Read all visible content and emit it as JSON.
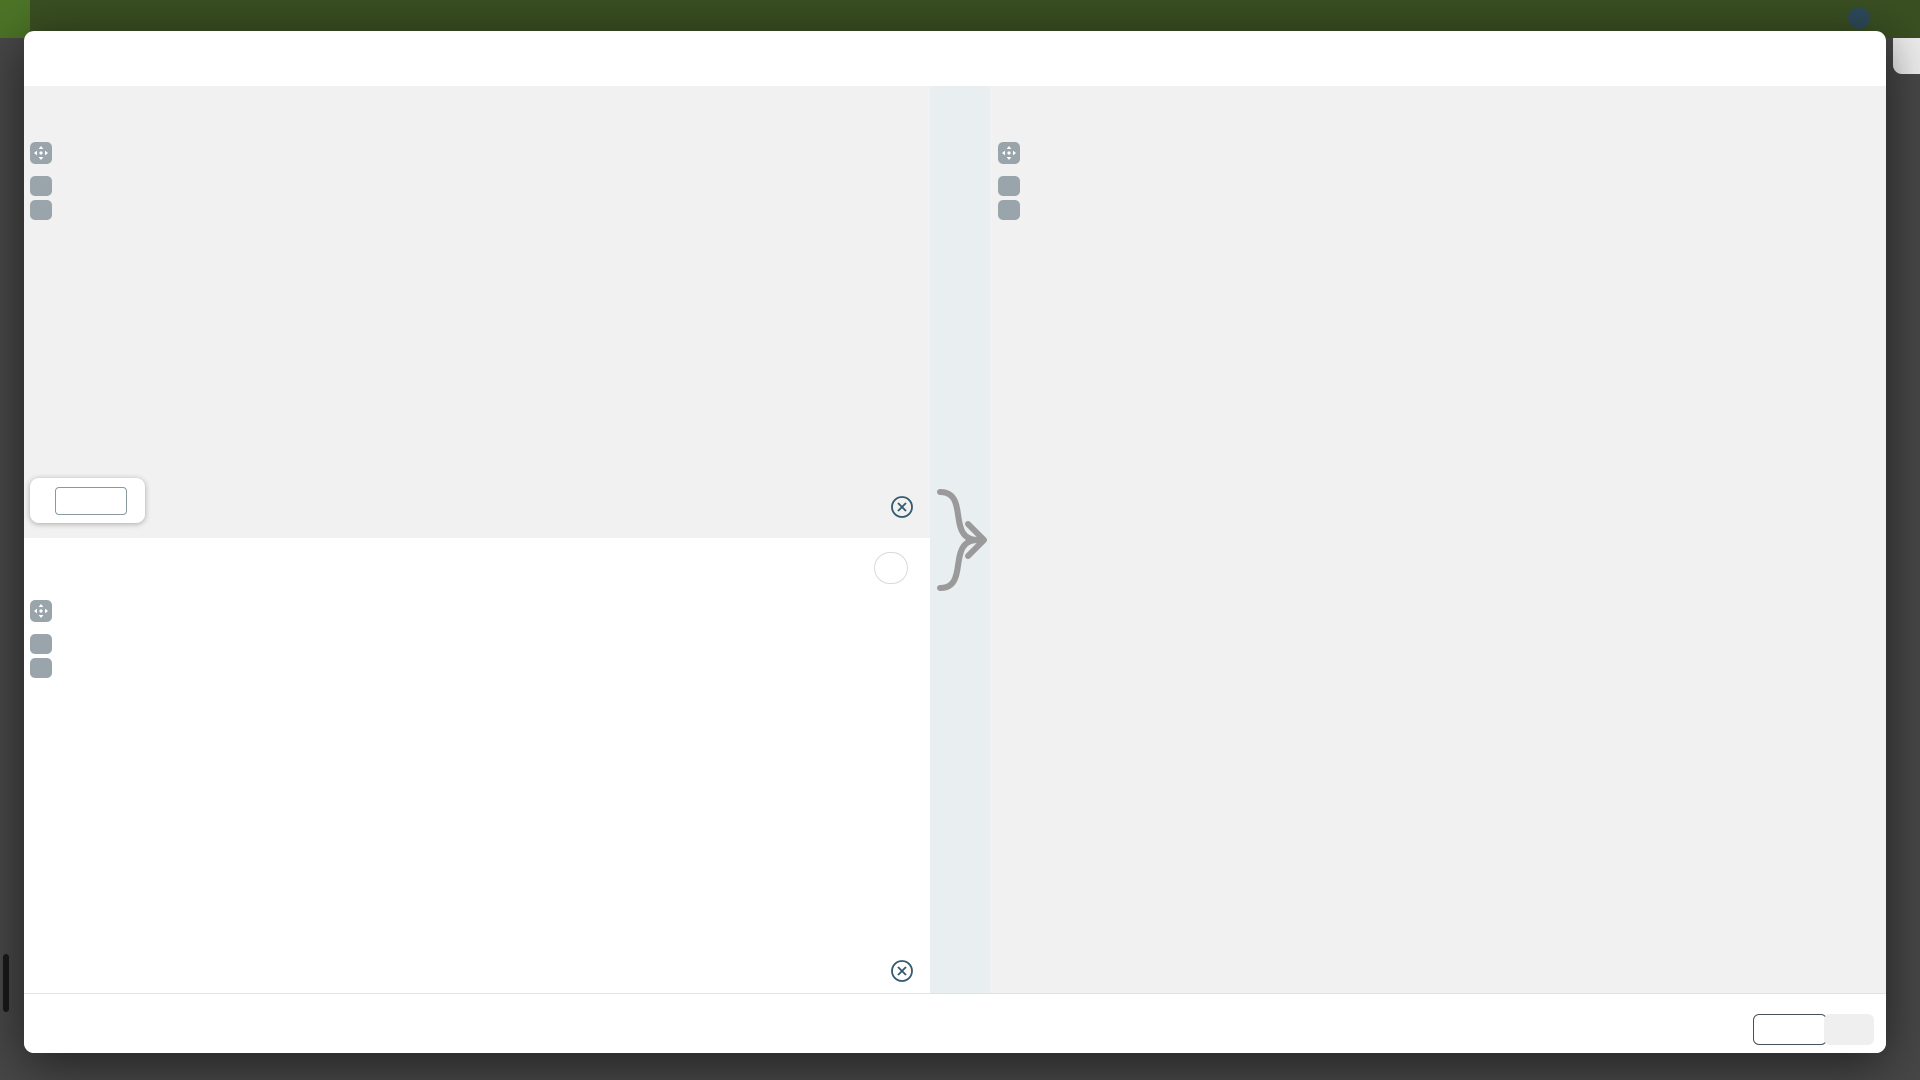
{
  "background": {
    "locations": "Locations",
    "user_name": "Søren Lang",
    "user_initials": "SL",
    "help": "Help",
    "chevron": "⌄"
  },
  "modal": {
    "title": "Place the drawing on the level 'LEVEL 00' in relation to the 3D model",
    "close": "✕"
  },
  "controls": {
    "plus": "+",
    "minus": "−"
  },
  "footer": {
    "cancel": "Cancel",
    "ok": "OK"
  },
  "colors": {
    "accent": "#79b939",
    "overlay": "#76b82a",
    "marker": "#345a6d",
    "ok_bg": "#8bc34a",
    "ab_letter": "#8ba18c",
    "wall": "#4a4a4a"
  },
  "current_panel": {
    "heading": "Current drawing",
    "drawing_title": "128-ABC-00-DR-A-103-GA PLAN LEVEL 00 GROUND",
    "scale_label": "Scale",
    "scale_prefix": "1 :",
    "scale_unit": "m",
    "scale_value": "",
    "sections": {
      "cc": "SECTION C-C",
      "bb": "SECTION B-B"
    },
    "grid_top": [
      "4",
      "5",
      "6"
    ],
    "grid_x": [
      "X4",
      "X5",
      "X6",
      "X7",
      "X8",
      "X9",
      "X10",
      "X11"
    ],
    "dim_span": "7200",
    "dim_bay": "2400",
    "dim_door": "310",
    "markers": [
      "1",
      "2"
    ],
    "point_a": "A",
    "point_b": "B",
    "rooms": {
      "group": [
        "00.12",
        "GROUP ROOM",
        "164 m²"
      ],
      "hold": [
        "00.130",
        "HOLD ROOM",
        "187 m²"
      ]
    }
  },
  "match_panel": {
    "heading": "Match drawing",
    "badge": "LEVEL 00 • auto drawing",
    "markers": [
      "3",
      "4"
    ],
    "point_a": "A",
    "point_b": "B",
    "rooms": {
      "group": [
        "00.12",
        "GROUP ROOM"
      ],
      "hold": [
        "00.130",
        "HOLD ROOM"
      ]
    }
  },
  "combined_panel": {
    "heading": "Combined display",
    "subtitle": "For validation purposes",
    "grid_top": [
      "1",
      "2",
      "4"
    ],
    "grid_x": [
      "X1",
      "X2",
      "X3",
      "X4",
      "X5",
      "X6",
      "X7"
    ],
    "grid_left": [
      "A",
      "B",
      "C"
    ],
    "grid_y": [
      "Y1",
      "Y2",
      "Y3",
      "Y4",
      "Y5",
      "Y6",
      "Y7",
      "Y8",
      "Y9",
      "Y10"
    ],
    "sections": {
      "cc_top": "SECTION C-C",
      "cc_bottom": "SECTION C-C",
      "aa": "CTION A-A"
    },
    "dims": {
      "span": "7200",
      "first": "2275",
      "bay": "2400",
      "v1": "2475",
      "v2": "13550",
      "v3": "7945",
      "v4": "1957",
      "h1": "12015",
      "h2": "2480",
      "h3": "2992",
      "h4": "6406",
      "h5": "4525",
      "h6": "435",
      "h7": "2100",
      "s1": "1070",
      "s2": "1040",
      "s3": "1010"
    },
    "stall": "1x21M",
    "stall9": "9x21M",
    "rooms": {
      "wc_dis": [
        "00.01",
        "WC DIS",
        "9 m²"
      ],
      "wash": [
        "00.07",
        "WASH",
        "15 m²"
      ],
      "xfield": [
        "00.06",
        "X FIELD",
        "25 m²"
      ],
      "printing": [
        "00.09",
        "PRINTING"
      ],
      "circ": [
        "00.11",
        "CIRCULATION",
        "11 m²"
      ],
      "shaft": [
        "00.10",
        "SHAFT",
        "7 m²"
      ],
      "group": [
        "00.12",
        "GROUP ROOM",
        "164 m²"
      ],
      "circ_ab": [
        "00.AB",
        "CIRCULATION",
        "361 m²"
      ],
      "canopy": [
        "00.22",
        "CANOPY",
        "5 m²"
      ]
    }
  }
}
